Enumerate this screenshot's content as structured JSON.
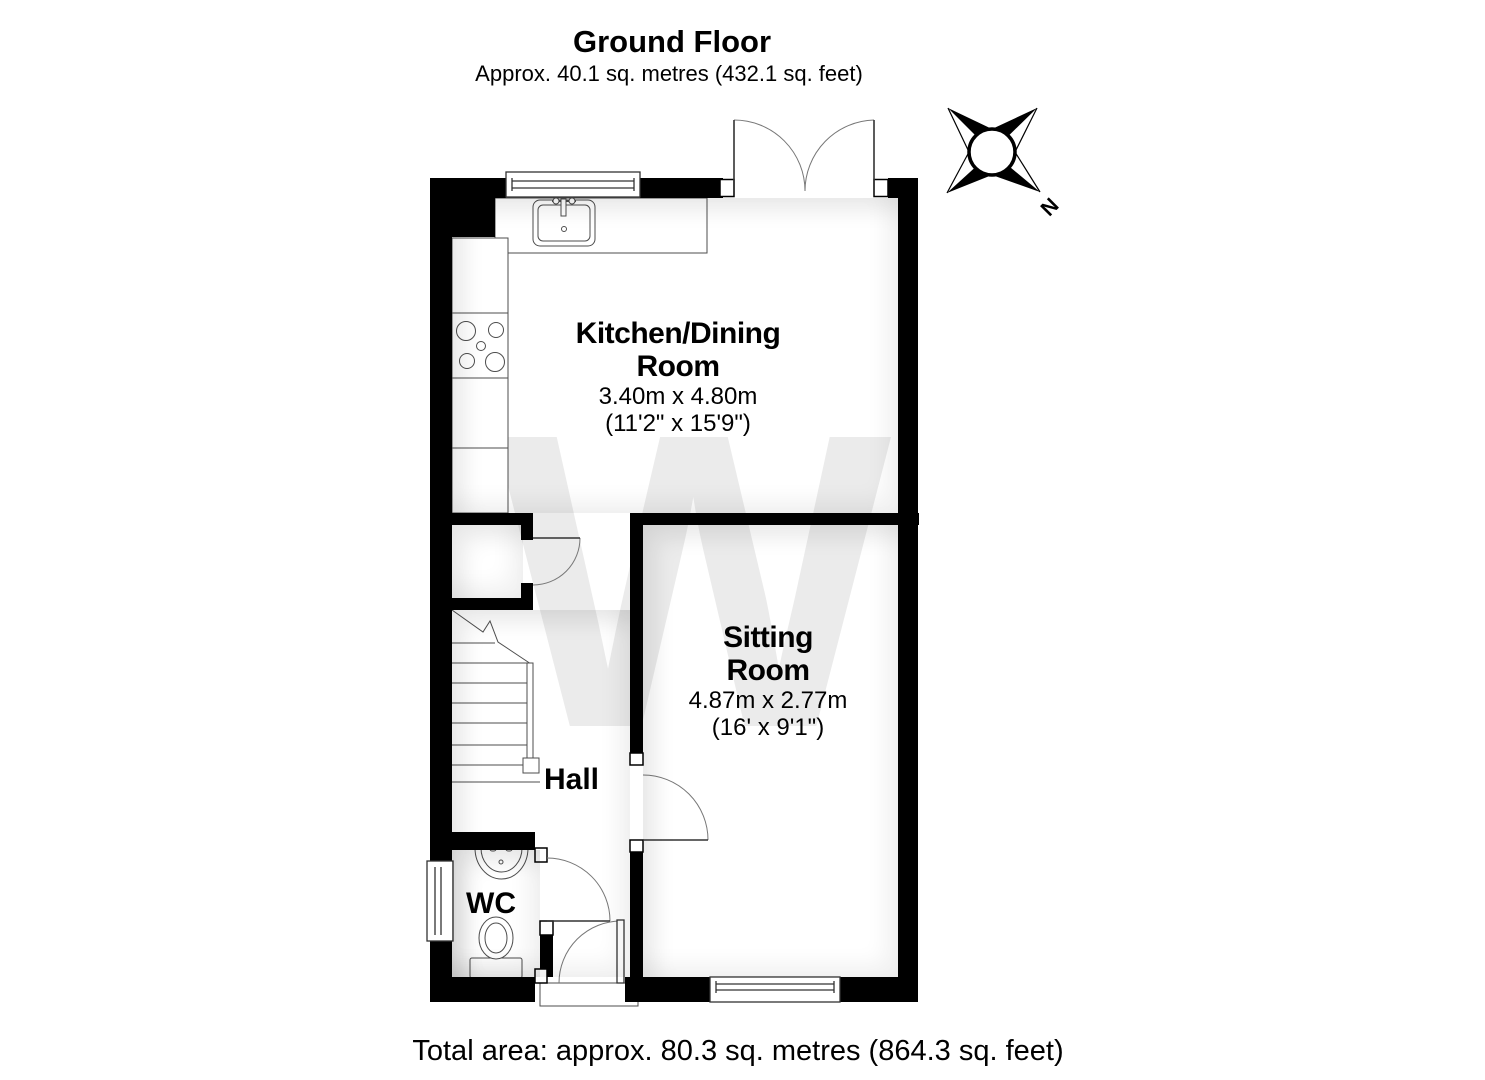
{
  "page": {
    "title": "Ground Floor",
    "subtitle": "Approx. 40.1 sq. metres (432.1 sq. feet)",
    "footer_total_area": "Total area: approx. 80.3 sq. metres (864.3 sq. feet)"
  },
  "rooms": {
    "kitchen_dining": {
      "name_line1": "Kitchen/Dining",
      "name_line2": "Room",
      "dimensions_metric": "3.40m x 4.80m",
      "dimensions_imperial": "(11'2\" x 15'9\")"
    },
    "sitting_room": {
      "name_line1": "Sitting",
      "name_line2": "Room",
      "dimensions_metric": "4.87m x 2.77m",
      "dimensions_imperial": "(16' x 9'1\")"
    },
    "hall": {
      "name": "Hall"
    },
    "wc": {
      "name": "WC"
    }
  },
  "compass": {
    "north_label": "N"
  },
  "watermark": {
    "letter": "W"
  },
  "colors": {
    "wall": "#000000",
    "fixture_line": "#4d4d4d",
    "door_arc": "#777777",
    "door_leaf": "#333333",
    "watermark": "#ebebeb",
    "background": "#ffffff",
    "text": "#000000"
  }
}
